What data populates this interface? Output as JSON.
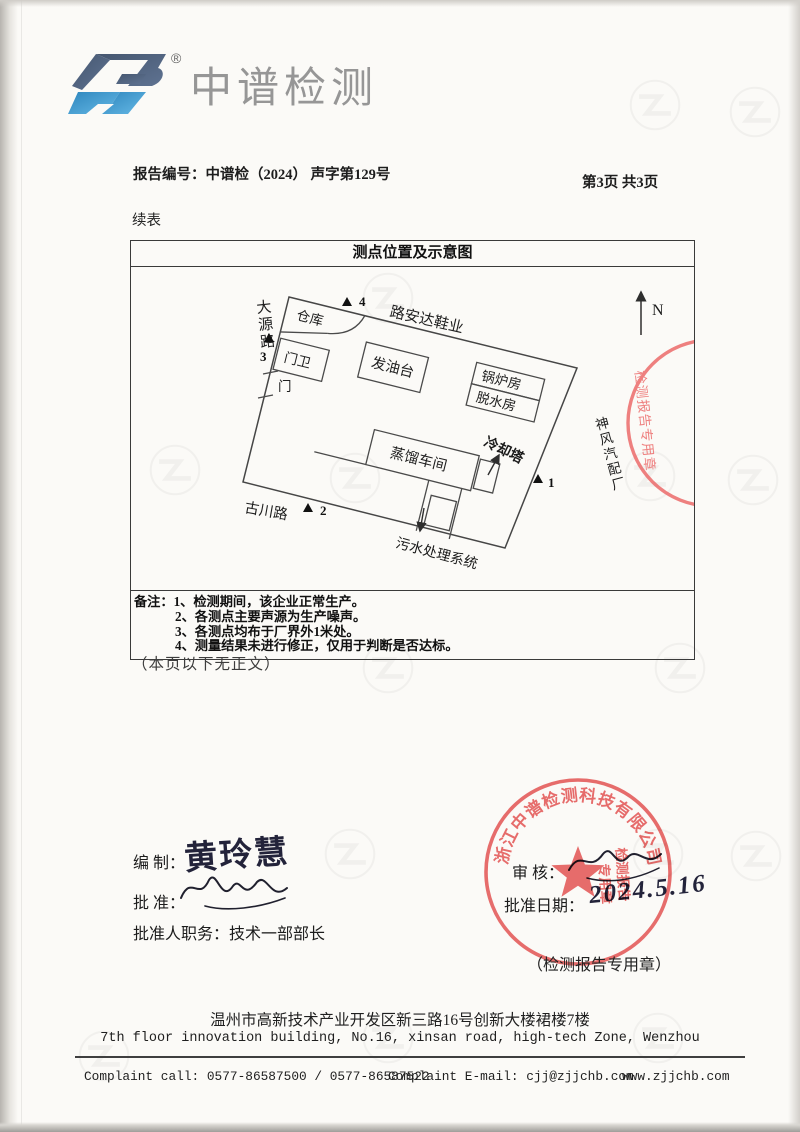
{
  "brand": {
    "name": "中谱检测",
    "reg": "®",
    "logo_dark": "#4f6080",
    "logo_blue": "#3d9ad1",
    "text_gray": "#969696"
  },
  "header": {
    "report_no_label": "报告编号：",
    "report_no": "中谱检（2024） 声字第129号",
    "page_info": "第3页 共3页",
    "continued_label": "续表"
  },
  "table": {
    "title": "测点位置及示意图"
  },
  "diagram": {
    "north": "N",
    "road_dayuan": "大源路",
    "road_guchuan": "古川路",
    "neighbor_top": "路安达鞋业",
    "neighbor_right": "神风汽配厂",
    "b_warehouse": "仓库",
    "b_gatehouse": "门卫",
    "b_oil_platform": "发油台",
    "b_boiler": "锅炉房",
    "b_dewater": "脱水房",
    "b_distillation": "蒸馏车间",
    "b_cooling_tower": "冷却塔",
    "b_sewage": "污水处理系统",
    "gate": "门",
    "p1": "1",
    "p2": "2",
    "p3": "3",
    "p4": "4"
  },
  "notes": {
    "label": "备注：",
    "items": [
      "1、检测期间，该企业正常生产。",
      "2、各测点主要声源为生产噪声。",
      "3、各测点均布于厂界外1米处。",
      "4、测量结果未进行修正，仅用于判断是否达标。"
    ]
  },
  "after_table_note": "（本页以下无正文）",
  "signatures": {
    "prepared_label": "编 制：",
    "prepared_signature": "黄玲慧",
    "approved_label": "批 准：",
    "reviewed_label": "审 核：",
    "approver_title_label": "批准人职务：",
    "approver_title": "技术一部部长",
    "approval_date_label": "批准日期：",
    "approval_date": "2024.5.16"
  },
  "stamps": {
    "ring_company": "浙江中谱检测科技有限公司",
    "seal_line1": "检测报告",
    "seal_line2": "专用章",
    "seal_vertical": "检测报告专用章",
    "caption": "（检测报告专用章）",
    "red": "#e85f5f"
  },
  "footer": {
    "address_cn": "温州市高新技术产业开发区新三路16号创新大楼裙楼7楼",
    "address_en": "7th floor innovation building, No.16, xinsan road, high-tech Zone, Wenzhou",
    "complaint_call": "Complaint call: 0577-86587500 / 0577-86587522",
    "complaint_email": "Complaint E-mail: cjj@zjjchb.com",
    "website": "www.zjjchb.com"
  }
}
